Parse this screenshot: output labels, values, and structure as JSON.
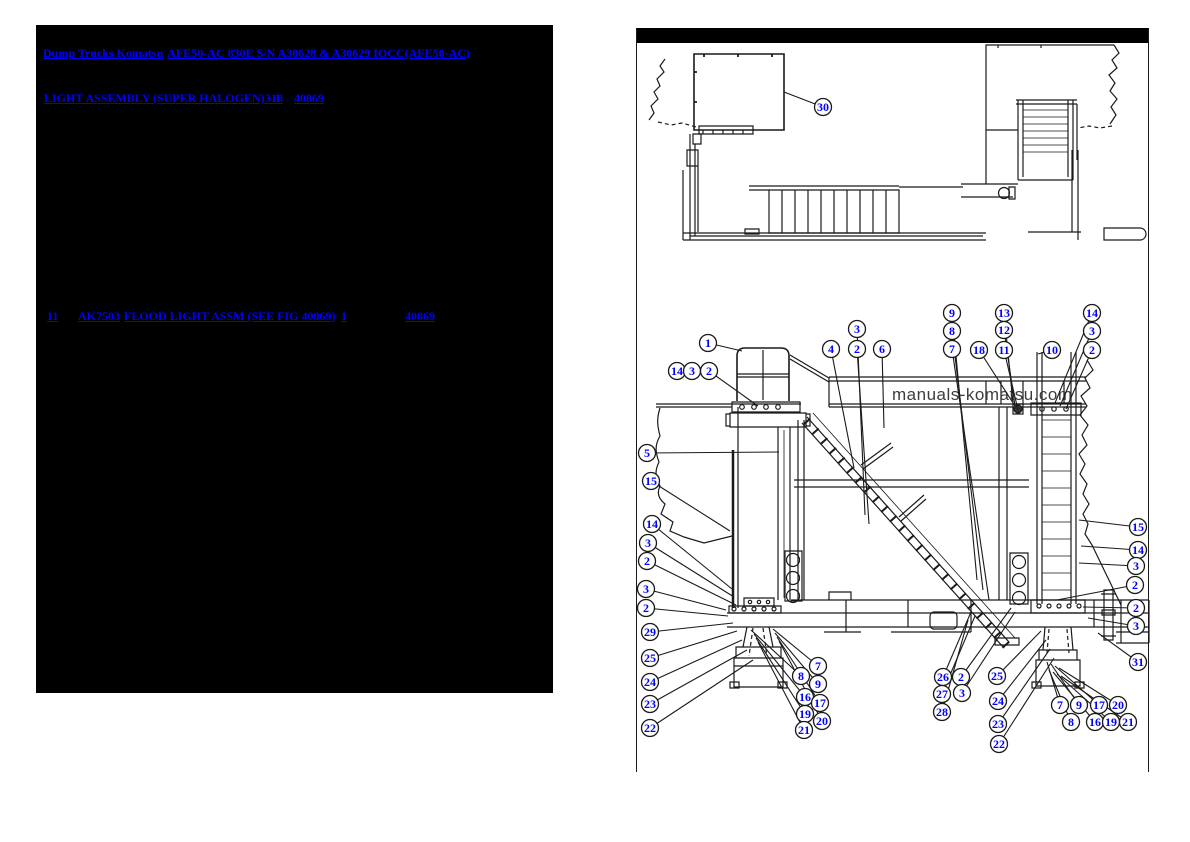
{
  "left_panel": {
    "title_links": [
      "Dump Trucks Komatsu",
      "AFE50-AC 830E  S/N A30628 & A30629 IOCC(AFE50-AC)"
    ],
    "assembly_links": [
      "LIGHT ASSEMBLY (SUPER HALOGEN) - 1",
      "318",
      "40869"
    ],
    "part_row": {
      "item_no": "11",
      "part_no": "AK7503",
      "description": "FLOOD LIGHT ASSM (SEE FIG 40869)",
      "qty": "1",
      "fig": "40869"
    }
  },
  "right_panel": {
    "watermark": "manuals-komatsu.com",
    "colors": {
      "link_blue": "#0000ff",
      "line": "#1a1a1a",
      "watermark_gray": "#3d3d3d"
    },
    "callouts": [
      {
        "n": "30",
        "x": 822,
        "y": 107,
        "tx": 783,
        "ty": 92
      },
      {
        "n": "1",
        "x": 707,
        "y": 343,
        "tx": 741,
        "ty": 351
      },
      {
        "n": "14",
        "x": 676,
        "y": 371,
        "tx": null,
        "ty": null
      },
      {
        "n": "3",
        "x": 691,
        "y": 371,
        "tx": null,
        "ty": null
      },
      {
        "n": "2",
        "x": 708,
        "y": 371,
        "tx": 757,
        "ty": 406
      },
      {
        "n": "4",
        "x": 830,
        "y": 349,
        "tx": 853,
        "ty": 468
      },
      {
        "n": "3",
        "x": 856,
        "y": 329,
        "tx": 864,
        "ty": 515
      },
      {
        "n": "2",
        "x": 856,
        "y": 349,
        "tx": 868,
        "ty": 524
      },
      {
        "n": "6",
        "x": 881,
        "y": 349,
        "tx": 883,
        "ty": 428
      },
      {
        "n": "9",
        "x": 951,
        "y": 313,
        "tx": 976,
        "ty": 580
      },
      {
        "n": "8",
        "x": 951,
        "y": 331,
        "tx": 982,
        "ty": 590
      },
      {
        "n": "7",
        "x": 951,
        "y": 349,
        "tx": 988,
        "ty": 600
      },
      {
        "n": "18",
        "x": 978,
        "y": 350,
        "tx": 1014,
        "ty": 406
      },
      {
        "n": "13",
        "x": 1003,
        "y": 313,
        "tx": 1012,
        "ty": 403
      },
      {
        "n": "12",
        "x": 1003,
        "y": 330,
        "tx": 1014,
        "ty": 406
      },
      {
        "n": "11",
        "x": 1003,
        "y": 350,
        "tx": 1017,
        "ty": 410
      },
      {
        "n": "10",
        "x": 1051,
        "y": 350,
        "tx": 1037,
        "ty": 354
      },
      {
        "n": "14",
        "x": 1091,
        "y": 313,
        "tx": 1054,
        "ty": 403
      },
      {
        "n": "3",
        "x": 1091,
        "y": 331,
        "tx": 1059,
        "ty": 406
      },
      {
        "n": "2",
        "x": 1091,
        "y": 350,
        "tx": 1065,
        "ty": 409
      },
      {
        "n": "5",
        "x": 646,
        "y": 453,
        "tx": 778,
        "ty": 452
      },
      {
        "n": "15",
        "x": 650,
        "y": 481,
        "tx": 729,
        "ty": 531
      },
      {
        "n": "14",
        "x": 651,
        "y": 524,
        "tx": 731,
        "ty": 589
      },
      {
        "n": "3",
        "x": 647,
        "y": 543,
        "tx": 733,
        "ty": 597
      },
      {
        "n": "2",
        "x": 646,
        "y": 561,
        "tx": 735,
        "ty": 605
      },
      {
        "n": "3",
        "x": 645,
        "y": 589,
        "tx": 725,
        "ty": 610
      },
      {
        "n": "2",
        "x": 645,
        "y": 608,
        "tx": 727,
        "ty": 616
      },
      {
        "n": "29",
        "x": 649,
        "y": 632,
        "tx": 732,
        "ty": 623
      },
      {
        "n": "25",
        "x": 649,
        "y": 658,
        "tx": 736,
        "ty": 631
      },
      {
        "n": "24",
        "x": 649,
        "y": 682,
        "tx": 741,
        "ty": 640
      },
      {
        "n": "23",
        "x": 649,
        "y": 704,
        "tx": 746,
        "ty": 650
      },
      {
        "n": "22",
        "x": 649,
        "y": 728,
        "tx": 752,
        "ty": 660
      },
      {
        "n": "8",
        "x": 800,
        "y": 676,
        "tx": 750,
        "ty": 630
      },
      {
        "n": "7",
        "x": 817,
        "y": 666,
        "tx": 772,
        "ty": 629
      },
      {
        "n": "9",
        "x": 817,
        "y": 684,
        "tx": 774,
        "ty": 633
      },
      {
        "n": "16",
        "x": 804,
        "y": 697,
        "tx": 753,
        "ty": 634
      },
      {
        "n": "17",
        "x": 819,
        "y": 703,
        "tx": 776,
        "ty": 637
      },
      {
        "n": "19",
        "x": 804,
        "y": 714,
        "tx": 755,
        "ty": 638
      },
      {
        "n": "20",
        "x": 821,
        "y": 721,
        "tx": 778,
        "ty": 641
      },
      {
        "n": "21",
        "x": 803,
        "y": 730,
        "tx": 757,
        "ty": 642
      },
      {
        "n": "26",
        "x": 942,
        "y": 677,
        "tx": 970,
        "ty": 612
      },
      {
        "n": "27",
        "x": 941,
        "y": 694,
        "tx": 974,
        "ty": 616
      },
      {
        "n": "28",
        "x": 941,
        "y": 712,
        "tx": 967,
        "ty": 620
      },
      {
        "n": "2",
        "x": 960,
        "y": 677,
        "tx": 1010,
        "ty": 608
      },
      {
        "n": "3",
        "x": 961,
        "y": 693,
        "tx": 1014,
        "ty": 612
      },
      {
        "n": "25",
        "x": 996,
        "y": 676,
        "tx": 1040,
        "ty": 631
      },
      {
        "n": "24",
        "x": 997,
        "y": 701,
        "tx": 1045,
        "ty": 640
      },
      {
        "n": "23",
        "x": 997,
        "y": 724,
        "tx": 1049,
        "ty": 649
      },
      {
        "n": "22",
        "x": 998,
        "y": 744,
        "tx": 1053,
        "ty": 658
      },
      {
        "n": "7",
        "x": 1059,
        "y": 705,
        "tx": 1046,
        "ty": 662
      },
      {
        "n": "9",
        "x": 1078,
        "y": 705,
        "tx": 1050,
        "ty": 664
      },
      {
        "n": "17",
        "x": 1098,
        "y": 705,
        "tx": 1054,
        "ty": 666
      },
      {
        "n": "20",
        "x": 1117,
        "y": 705,
        "tx": 1058,
        "ty": 668
      },
      {
        "n": "8",
        "x": 1070,
        "y": 722,
        "tx": 1048,
        "ty": 670
      },
      {
        "n": "16",
        "x": 1094,
        "y": 722,
        "tx": 1052,
        "ty": 672
      },
      {
        "n": "19",
        "x": 1110,
        "y": 722,
        "tx": 1056,
        "ty": 674
      },
      {
        "n": "21",
        "x": 1127,
        "y": 722,
        "tx": 1060,
        "ty": 676
      },
      {
        "n": "15",
        "x": 1137,
        "y": 527,
        "tx": 1078,
        "ty": 520
      },
      {
        "n": "14",
        "x": 1137,
        "y": 550,
        "tx": 1080,
        "ty": 546
      },
      {
        "n": "3",
        "x": 1135,
        "y": 566,
        "tx": 1078,
        "ty": 563
      },
      {
        "n": "2",
        "x": 1134,
        "y": 585,
        "tx": 1056,
        "ty": 600
      },
      {
        "n": "2",
        "x": 1135,
        "y": 608,
        "tx": 1082,
        "ty": 607
      },
      {
        "n": "3",
        "x": 1135,
        "y": 626,
        "tx": 1087,
        "ty": 618
      },
      {
        "n": "31",
        "x": 1137,
        "y": 662,
        "tx": 1097,
        "ty": 633
      }
    ]
  }
}
